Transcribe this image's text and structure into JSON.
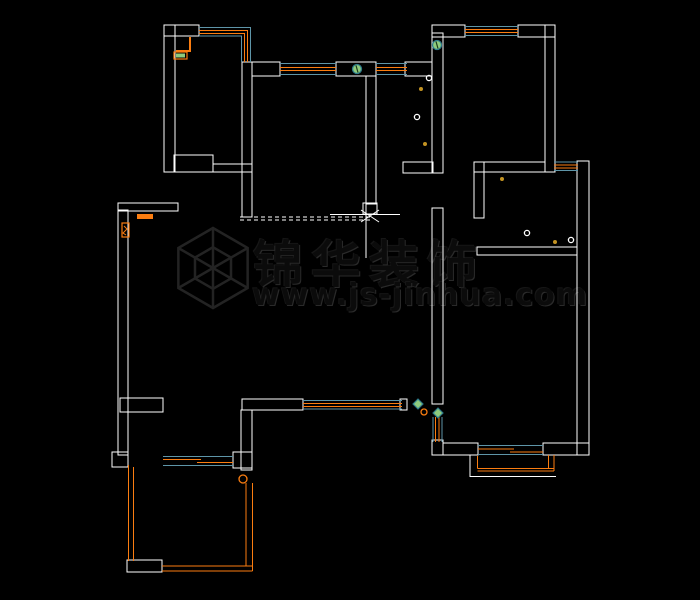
{
  "page": {
    "width": 700,
    "height": 600,
    "background": "#000000"
  },
  "watermark": {
    "title": "锦华装饰",
    "url": "www.js-jinhua.com",
    "logo": "hexagon-cube-logo",
    "logo_cx": 213,
    "logo_cy": 268,
    "logo_r": 40,
    "logo_inner_ratio": 0.52,
    "ink": "#232323"
  },
  "colors": {
    "wall": "#ffffff",
    "window_frame": "#fb7d10",
    "window_glass": "#5e95a8",
    "switch_fill": "#8fcb7d",
    "switch_ring": "#2f7d8c",
    "dot": "#c39322",
    "accent_orange": "#fb7d10",
    "accent_green": "#8fcb7d"
  },
  "floorplan": {
    "wall_rects": [
      [
        164,
        25,
        11,
        147
      ],
      [
        164,
        25,
        35,
        11
      ],
      [
        174,
        155,
        39,
        17
      ],
      [
        213,
        164,
        39,
        8
      ],
      [
        242,
        62,
        10,
        155
      ],
      [
        252,
        62,
        28,
        14
      ],
      [
        336,
        62,
        40,
        14
      ],
      [
        366,
        76,
        10,
        128
      ],
      [
        405,
        62,
        27,
        14
      ],
      [
        432,
        33,
        11,
        140
      ],
      [
        403,
        162,
        30,
        11
      ],
      [
        432,
        25,
        33,
        12
      ],
      [
        518,
        25,
        37,
        12
      ],
      [
        545,
        25,
        10,
        147
      ],
      [
        474,
        162,
        71,
        10
      ],
      [
        577,
        161,
        12,
        294
      ],
      [
        474,
        162,
        10,
        56
      ],
      [
        477,
        247,
        100,
        8
      ],
      [
        432,
        208,
        11,
        196
      ],
      [
        432,
        440,
        11,
        15
      ],
      [
        443,
        443,
        35,
        12
      ],
      [
        543,
        443,
        46,
        12
      ],
      [
        242,
        399,
        61,
        11
      ],
      [
        400,
        399,
        7,
        11
      ],
      [
        241,
        410,
        11,
        60
      ],
      [
        120,
        398,
        43,
        14
      ],
      [
        118,
        210,
        10,
        245
      ],
      [
        112,
        452,
        16,
        15
      ],
      [
        233,
        452,
        19,
        16
      ],
      [
        127,
        560,
        35,
        12
      ],
      [
        118,
        203,
        60,
        8
      ],
      [
        363,
        203,
        14,
        11
      ]
    ],
    "lines": [
      {
        "c": "g",
        "p": [
          [
            199,
            27.5
          ],
          [
            250.5,
            27.5
          ],
          [
            250.5,
            62
          ]
        ]
      },
      {
        "c": "g",
        "p": [
          [
            199,
            36
          ],
          [
            241.5,
            36
          ],
          [
            241.5,
            62
          ]
        ]
      },
      {
        "c": "o",
        "p": [
          [
            199,
            30.5
          ],
          [
            247.5,
            30.5
          ],
          [
            247.5,
            62
          ]
        ]
      },
      {
        "c": "o",
        "p": [
          [
            199,
            33.5
          ],
          [
            244.5,
            33.5
          ],
          [
            244.5,
            62
          ]
        ]
      },
      {
        "c": "g",
        "p": [
          [
            280,
            63.5
          ],
          [
            336,
            63.5
          ]
        ]
      },
      {
        "c": "g",
        "p": [
          [
            280,
            74.5
          ],
          [
            336,
            74.5
          ]
        ]
      },
      {
        "c": "o",
        "p": [
          [
            280,
            67.5
          ],
          [
            336,
            67.5
          ]
        ]
      },
      {
        "c": "o",
        "p": [
          [
            280,
            70.5
          ],
          [
            336,
            70.5
          ]
        ]
      },
      {
        "c": "g",
        "p": [
          [
            376,
            63.5
          ],
          [
            407,
            63.5
          ]
        ]
      },
      {
        "c": "g",
        "p": [
          [
            376,
            74.5
          ],
          [
            407,
            74.5
          ]
        ]
      },
      {
        "c": "o",
        "p": [
          [
            376,
            67.5
          ],
          [
            407,
            67.5
          ]
        ]
      },
      {
        "c": "o",
        "p": [
          [
            376,
            70.5
          ],
          [
            407,
            70.5
          ]
        ]
      },
      {
        "c": "g",
        "p": [
          [
            465,
            26.5
          ],
          [
            518,
            26.5
          ]
        ]
      },
      {
        "c": "g",
        "p": [
          [
            465,
            35.5
          ],
          [
            518,
            35.5
          ]
        ]
      },
      {
        "c": "o",
        "p": [
          [
            465,
            29.5
          ],
          [
            518,
            29.5
          ]
        ]
      },
      {
        "c": "o",
        "p": [
          [
            465,
            32.5
          ],
          [
            518,
            32.5
          ]
        ]
      },
      {
        "c": "g",
        "p": [
          [
            554,
            162
          ],
          [
            578,
            162
          ]
        ]
      },
      {
        "c": "g",
        "p": [
          [
            554,
            170.5
          ],
          [
            578,
            170.5
          ]
        ]
      },
      {
        "c": "o",
        "p": [
          [
            554,
            165
          ],
          [
            578,
            165
          ]
        ]
      },
      {
        "c": "o",
        "p": [
          [
            554,
            168
          ],
          [
            578,
            168
          ]
        ]
      },
      {
        "c": "g",
        "p": [
          [
            303,
            400.5
          ],
          [
            402,
            400.5
          ]
        ]
      },
      {
        "c": "g",
        "p": [
          [
            303,
            409
          ],
          [
            402,
            409
          ]
        ]
      },
      {
        "c": "o",
        "p": [
          [
            303,
            403.5
          ],
          [
            402,
            403.5
          ]
        ]
      },
      {
        "c": "o",
        "p": [
          [
            303,
            406.5
          ],
          [
            402,
            406.5
          ]
        ]
      },
      {
        "c": "g",
        "p": [
          [
            433,
            417
          ],
          [
            433,
            442
          ]
        ]
      },
      {
        "c": "g",
        "p": [
          [
            442,
            417
          ],
          [
            442,
            442
          ]
        ]
      },
      {
        "c": "o",
        "p": [
          [
            435.5,
            417
          ],
          [
            435.5,
            442
          ]
        ]
      },
      {
        "c": "o",
        "p": [
          [
            439,
            417
          ],
          [
            439,
            442
          ]
        ]
      },
      {
        "c": "g",
        "p": [
          [
            478,
            445.5
          ],
          [
            543,
            445.5
          ]
        ]
      },
      {
        "c": "g",
        "p": [
          [
            478,
            454.5
          ],
          [
            543,
            454.5
          ]
        ]
      },
      {
        "c": "o",
        "p": [
          [
            478,
            449
          ],
          [
            514,
            449
          ]
        ]
      },
      {
        "c": "o",
        "p": [
          [
            510,
            452
          ],
          [
            543,
            452
          ]
        ]
      },
      {
        "c": "g",
        "p": [
          [
            163,
            456.5
          ],
          [
            233,
            456.5
          ]
        ]
      },
      {
        "c": "g",
        "p": [
          [
            163,
            465.5
          ],
          [
            233,
            465.5
          ]
        ]
      },
      {
        "c": "o",
        "p": [
          [
            163,
            459.5
          ],
          [
            201,
            459.5
          ]
        ]
      },
      {
        "c": "o",
        "p": [
          [
            197,
            462.5
          ],
          [
            233,
            462.5
          ]
        ]
      },
      {
        "c": "o",
        "p": [
          [
            128.5,
            465
          ],
          [
            128.5,
            561
          ]
        ]
      },
      {
        "c": "o",
        "p": [
          [
            133.5,
            467
          ],
          [
            133.5,
            561
          ]
        ]
      },
      {
        "c": "o",
        "p": [
          [
            162,
            566
          ],
          [
            252.5,
            566
          ]
        ]
      },
      {
        "c": "o",
        "p": [
          [
            162,
            571
          ],
          [
            252.5,
            571
          ]
        ]
      },
      {
        "c": "o",
        "p": [
          [
            246,
            483
          ],
          [
            246,
            566
          ]
        ]
      },
      {
        "c": "o",
        "p": [
          [
            252.5,
            483
          ],
          [
            252.5,
            571
          ]
        ]
      },
      {
        "c": "w",
        "p": [
          [
            470,
            455
          ],
          [
            470,
            476.5
          ],
          [
            556,
            476.5
          ]
        ]
      },
      {
        "c": "o",
        "p": [
          [
            477.5,
            456
          ],
          [
            477.5,
            468.5
          ]
        ]
      },
      {
        "c": "o",
        "p": [
          [
            477.5,
            468.5
          ],
          [
            554,
            468.5
          ]
        ]
      },
      {
        "c": "o",
        "p": [
          [
            477.5,
            471
          ],
          [
            554,
            471
          ]
        ]
      },
      {
        "c": "o",
        "p": [
          [
            548.5,
            455
          ],
          [
            548.5,
            468.5
          ]
        ]
      },
      {
        "c": "o",
        "p": [
          [
            554,
            455
          ],
          [
            554,
            471
          ]
        ]
      },
      {
        "c": "w",
        "p": [
          [
            330,
            214.5
          ],
          [
            400,
            214.5
          ]
        ]
      },
      {
        "c": "w",
        "p": [
          [
            366,
            204
          ],
          [
            366,
            258
          ]
        ]
      },
      {
        "c": "w",
        "p": [
          [
            361,
            210
          ],
          [
            379,
            222
          ]
        ]
      },
      {
        "c": "w",
        "p": [
          [
            361,
            222
          ],
          [
            379,
            210
          ]
        ]
      },
      {
        "c": "w",
        "d": 1,
        "p": [
          [
            240,
            217
          ],
          [
            372,
            217
          ]
        ]
      },
      {
        "c": "w",
        "d": 1,
        "p": [
          [
            240,
            220
          ],
          [
            372,
            220
          ]
        ]
      },
      {
        "c": "o",
        "p": [
          [
            190,
            37
          ],
          [
            190,
            51
          ],
          [
            176,
            51
          ]
        ],
        "sw": 2
      },
      {
        "c": "o",
        "p": [
          [
            124,
            226
          ],
          [
            127,
            229
          ],
          [
            123,
            233
          ],
          [
            126,
            235
          ]
        ]
      }
    ],
    "orange_boxes": [
      {
        "t": "frect",
        "x": 137,
        "y": 214,
        "w": 16,
        "h": 5
      },
      {
        "t": "obox",
        "x": 122,
        "y": 223,
        "w": 7,
        "h": 14
      },
      {
        "t": "obox",
        "x": 174,
        "y": 52,
        "w": 13,
        "h": 7
      },
      {
        "t": "gfill",
        "x": 176,
        "y": 53.5,
        "w": 9,
        "h": 4
      }
    ],
    "symbols": [
      {
        "t": "switch",
        "x": 357,
        "y": 69
      },
      {
        "t": "switch",
        "x": 437,
        "y": 45
      },
      {
        "t": "diamond",
        "x": 418,
        "y": 404
      },
      {
        "t": "diamond",
        "x": 438,
        "y": 413
      },
      {
        "t": "dot",
        "x": 421,
        "y": 89
      },
      {
        "t": "dot",
        "x": 425,
        "y": 144
      },
      {
        "t": "dot",
        "x": 502,
        "y": 179
      },
      {
        "t": "dot",
        "x": 555,
        "y": 242
      },
      {
        "t": "fixture",
        "x": 417,
        "y": 117
      },
      {
        "t": "fixture",
        "x": 429,
        "y": 78
      },
      {
        "t": "fixture",
        "x": 527,
        "y": 233
      },
      {
        "t": "fixture",
        "x": 571,
        "y": 240
      },
      {
        "t": "oring",
        "x": 243,
        "y": 479,
        "r": 4
      },
      {
        "t": "oring",
        "x": 424,
        "y": 412,
        "r": 3
      }
    ]
  }
}
